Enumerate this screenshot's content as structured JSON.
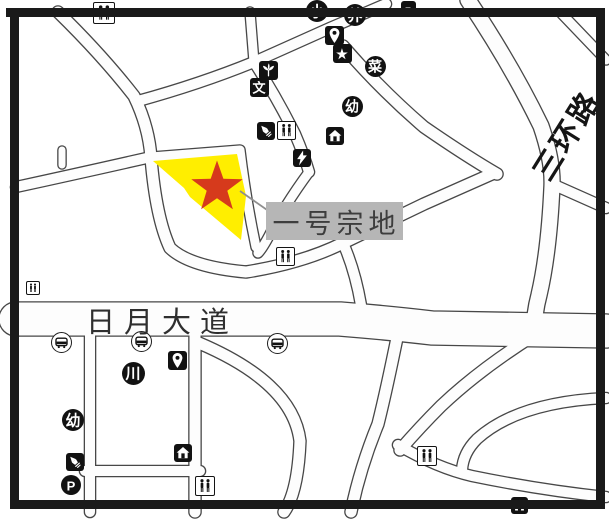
{
  "map": {
    "parcel_label": "一号宗地",
    "road_labels": [
      {
        "text": "日月大道"
      },
      {
        "text": "三环路"
      }
    ],
    "markers": {
      "star": "red-star-marker",
      "parcel": "highlighted-parcel"
    },
    "colors": {
      "parcel_fill": "#FFEE00",
      "star": "#D63A1C",
      "label_bg": "#B6B6B6",
      "road_line": "#474747",
      "border": "#1A1A1A"
    },
    "icons": [
      {
        "name": "toilet-icon",
        "kind": "wc",
        "x": 104,
        "y": 13,
        "s": 22
      },
      {
        "name": "partial-vehicle-icon",
        "kind": "square",
        "glyph": "–",
        "x": 408,
        "y": 8,
        "s": 15
      },
      {
        "name": "primary-school-icon",
        "kind": "circle",
        "glyph": "小",
        "x": 317,
        "y": 11,
        "s": 22
      },
      {
        "name": "nursing-home-icon",
        "kind": "circle",
        "glyph": "养",
        "x": 355,
        "y": 15,
        "s": 22
      },
      {
        "name": "location-pin-icon",
        "kind": "square",
        "svg": "pin",
        "x": 334,
        "y": 35,
        "s": 19
      },
      {
        "name": "star-poi-icon",
        "kind": "square",
        "glyph": "★",
        "x": 342,
        "y": 53,
        "s": 19
      },
      {
        "name": "vegetable-market-icon",
        "kind": "circle",
        "glyph": "菜",
        "x": 375,
        "y": 66,
        "s": 21
      },
      {
        "name": "flower-icon",
        "kind": "square",
        "svg": "flower",
        "x": 268,
        "y": 70,
        "s": 19
      },
      {
        "name": "culture-icon",
        "kind": "square",
        "glyph": "文",
        "x": 259,
        "y": 87,
        "s": 19
      },
      {
        "name": "kindergarten-icon",
        "kind": "circle",
        "glyph": "幼",
        "x": 352,
        "y": 106,
        "s": 21
      },
      {
        "name": "rocket-icon",
        "kind": "square",
        "svg": "rocket",
        "x": 266,
        "y": 131,
        "s": 18
      },
      {
        "name": "toilet-icon",
        "kind": "wc",
        "x": 286,
        "y": 130,
        "s": 19
      },
      {
        "name": "home-icon",
        "kind": "square",
        "svg": "home",
        "x": 335,
        "y": 136,
        "s": 18
      },
      {
        "name": "lightning-icon",
        "kind": "square",
        "svg": "bolt",
        "x": 302,
        "y": 158,
        "s": 18
      },
      {
        "name": "toilet-icon",
        "kind": "wc",
        "x": 285,
        "y": 256,
        "s": 19
      },
      {
        "name": "toilet-icon",
        "kind": "wc",
        "x": 33,
        "y": 288,
        "s": 14
      },
      {
        "name": "bus-stop-icon",
        "kind": "bus",
        "x": 61,
        "y": 342,
        "s": 21
      },
      {
        "name": "bus-stop-icon",
        "kind": "bus",
        "x": 141,
        "y": 341,
        "s": 21
      },
      {
        "name": "bus-stop-icon",
        "kind": "bus",
        "x": 277,
        "y": 343,
        "s": 21
      },
      {
        "name": "location-pin-icon",
        "kind": "square",
        "svg": "pin",
        "x": 177,
        "y": 360,
        "s": 19
      },
      {
        "name": "chuan-icon",
        "kind": "circle",
        "glyph": "川",
        "x": 133,
        "y": 373,
        "s": 23
      },
      {
        "name": "kindergarten-icon",
        "kind": "circle",
        "glyph": "幼",
        "x": 73,
        "y": 420,
        "s": 22
      },
      {
        "name": "rocket-icon",
        "kind": "square",
        "svg": "rocket",
        "x": 75,
        "y": 462,
        "s": 18
      },
      {
        "name": "parking-icon",
        "kind": "circle",
        "glyph": "P",
        "x": 71,
        "y": 485,
        "s": 20
      },
      {
        "name": "home-icon",
        "kind": "square",
        "svg": "home",
        "x": 183,
        "y": 453,
        "s": 18
      },
      {
        "name": "toilet-icon",
        "kind": "wc",
        "x": 205,
        "y": 486,
        "s": 20
      },
      {
        "name": "toilet-icon",
        "kind": "wc",
        "x": 427,
        "y": 456,
        "s": 20
      },
      {
        "name": "home-icon",
        "kind": "square",
        "svg": "home",
        "x": 519,
        "y": 505,
        "s": 17
      }
    ]
  }
}
